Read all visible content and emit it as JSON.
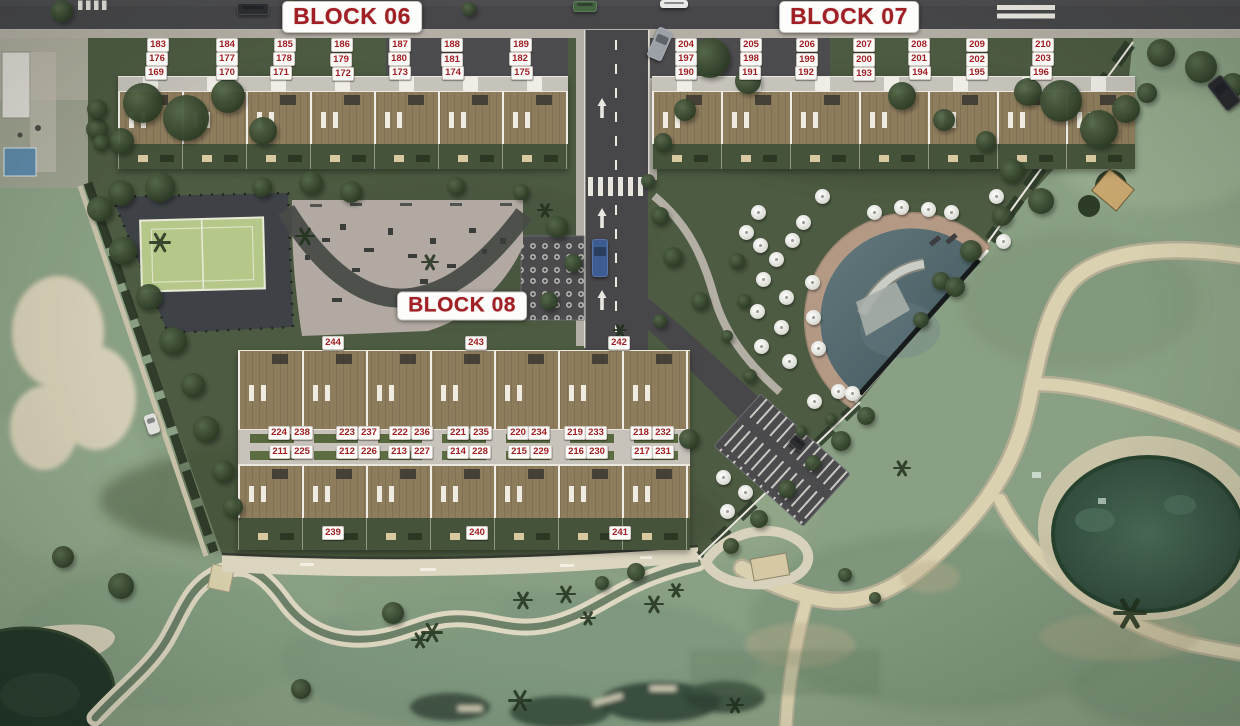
{
  "blocks": [
    {
      "label": "BLOCK 06"
    },
    {
      "label": "BLOCK 07"
    },
    {
      "label": "BLOCK 08"
    }
  ],
  "unit_labels": [
    {
      "t": "183",
      "x": 158,
      "y": 45
    },
    {
      "t": "184",
      "x": 227,
      "y": 45
    },
    {
      "t": "185",
      "x": 285,
      "y": 45
    },
    {
      "t": "186",
      "x": 342,
      "y": 45
    },
    {
      "t": "187",
      "x": 400,
      "y": 45
    },
    {
      "t": "188",
      "x": 452,
      "y": 45
    },
    {
      "t": "189",
      "x": 521,
      "y": 45
    },
    {
      "t": "176",
      "x": 157,
      "y": 59
    },
    {
      "t": "177",
      "x": 227,
      "y": 59
    },
    {
      "t": "178",
      "x": 284,
      "y": 59
    },
    {
      "t": "179",
      "x": 341,
      "y": 60
    },
    {
      "t": "180",
      "x": 399,
      "y": 59
    },
    {
      "t": "181",
      "x": 452,
      "y": 60
    },
    {
      "t": "182",
      "x": 520,
      "y": 59
    },
    {
      "t": "169",
      "x": 156,
      "y": 73
    },
    {
      "t": "170",
      "x": 227,
      "y": 73
    },
    {
      "t": "171",
      "x": 281,
      "y": 73
    },
    {
      "t": "172",
      "x": 343,
      "y": 74
    },
    {
      "t": "173",
      "x": 400,
      "y": 73
    },
    {
      "t": "174",
      "x": 453,
      "y": 73
    },
    {
      "t": "175",
      "x": 522,
      "y": 73
    },
    {
      "t": "204",
      "x": 686,
      "y": 45
    },
    {
      "t": "205",
      "x": 751,
      "y": 45
    },
    {
      "t": "206",
      "x": 807,
      "y": 45
    },
    {
      "t": "207",
      "x": 864,
      "y": 45
    },
    {
      "t": "208",
      "x": 919,
      "y": 45
    },
    {
      "t": "209",
      "x": 977,
      "y": 45
    },
    {
      "t": "210",
      "x": 1043,
      "y": 45
    },
    {
      "t": "197",
      "x": 686,
      "y": 59
    },
    {
      "t": "198",
      "x": 751,
      "y": 59
    },
    {
      "t": "199",
      "x": 807,
      "y": 60
    },
    {
      "t": "200",
      "x": 864,
      "y": 60
    },
    {
      "t": "201",
      "x": 919,
      "y": 59
    },
    {
      "t": "202",
      "x": 977,
      "y": 60
    },
    {
      "t": "203",
      "x": 1043,
      "y": 59
    },
    {
      "t": "190",
      "x": 686,
      "y": 73
    },
    {
      "t": "191",
      "x": 750,
      "y": 73
    },
    {
      "t": "192",
      "x": 806,
      "y": 73
    },
    {
      "t": "193",
      "x": 864,
      "y": 74
    },
    {
      "t": "194",
      "x": 920,
      "y": 73
    },
    {
      "t": "195",
      "x": 977,
      "y": 73
    },
    {
      "t": "196",
      "x": 1041,
      "y": 73
    },
    {
      "t": "244",
      "x": 333,
      "y": 343
    },
    {
      "t": "243",
      "x": 476,
      "y": 343
    },
    {
      "t": "242",
      "x": 619,
      "y": 343
    },
    {
      "t": "224",
      "x": 279,
      "y": 433
    },
    {
      "t": "238",
      "x": 302,
      "y": 433
    },
    {
      "t": "223",
      "x": 347,
      "y": 433
    },
    {
      "t": "237",
      "x": 369,
      "y": 433
    },
    {
      "t": "222",
      "x": 400,
      "y": 433
    },
    {
      "t": "236",
      "x": 422,
      "y": 433
    },
    {
      "t": "221",
      "x": 458,
      "y": 433
    },
    {
      "t": "235",
      "x": 481,
      "y": 433
    },
    {
      "t": "220",
      "x": 518,
      "y": 433
    },
    {
      "t": "234",
      "x": 539,
      "y": 433
    },
    {
      "t": "219",
      "x": 575,
      "y": 433
    },
    {
      "t": "233",
      "x": 596,
      "y": 433
    },
    {
      "t": "218",
      "x": 641,
      "y": 433
    },
    {
      "t": "232",
      "x": 663,
      "y": 433
    },
    {
      "t": "211",
      "x": 280,
      "y": 452
    },
    {
      "t": "225",
      "x": 302,
      "y": 452
    },
    {
      "t": "212",
      "x": 347,
      "y": 452
    },
    {
      "t": "226",
      "x": 369,
      "y": 452
    },
    {
      "t": "213",
      "x": 399,
      "y": 452
    },
    {
      "t": "227",
      "x": 422,
      "y": 452
    },
    {
      "t": "214",
      "x": 458,
      "y": 452
    },
    {
      "t": "228",
      "x": 480,
      "y": 452
    },
    {
      "t": "215",
      "x": 519,
      "y": 452
    },
    {
      "t": "229",
      "x": 541,
      "y": 452
    },
    {
      "t": "216",
      "x": 576,
      "y": 452
    },
    {
      "t": "230",
      "x": 597,
      "y": 452
    },
    {
      "t": "217",
      "x": 642,
      "y": 452
    },
    {
      "t": "231",
      "x": 663,
      "y": 452
    },
    {
      "t": "239",
      "x": 333,
      "y": 533
    },
    {
      "t": "240",
      "x": 477,
      "y": 533
    },
    {
      "t": "241",
      "x": 620,
      "y": 533
    }
  ],
  "colors": {
    "label_red": "#A02025",
    "badge_bg": "#FDFDFB",
    "asphalt": "#47474A",
    "sidewalk": "#B4AFA5",
    "development_green": "#4D5B42",
    "golf_green": "#8AA084",
    "deck_brown": "#8E7D5D",
    "pool_water": "#4E656B",
    "pond_water": "#3C5949",
    "sand_path": "#D9D1B0",
    "court_green": "#B6C78A",
    "umbrella_white": "#F4F4F2"
  },
  "scenery": {
    "trees": [
      [
        143,
        103,
        40
      ],
      [
        186,
        118,
        46
      ],
      [
        228,
        96,
        34
      ],
      [
        263,
        131,
        28
      ],
      [
        121,
        141,
        26
      ],
      [
        97,
        129,
        22
      ],
      [
        160,
        187,
        30
      ],
      [
        121,
        193,
        26
      ],
      [
        262,
        187,
        20
      ],
      [
        311,
        183,
        24
      ],
      [
        351,
        192,
        22
      ],
      [
        456,
        186,
        18
      ],
      [
        521,
        192,
        16
      ],
      [
        557,
        227,
        22
      ],
      [
        573,
        263,
        18
      ],
      [
        549,
        301,
        18
      ],
      [
        710,
        58,
        40
      ],
      [
        748,
        81,
        26
      ],
      [
        685,
        110,
        22
      ],
      [
        663,
        142,
        18
      ],
      [
        902,
        96,
        28
      ],
      [
        944,
        120,
        22
      ],
      [
        1028,
        92,
        28
      ],
      [
        1061,
        101,
        42
      ],
      [
        1099,
        129,
        38
      ],
      [
        1126,
        109,
        28
      ],
      [
        986,
        141,
        20
      ],
      [
        1012,
        171,
        24
      ],
      [
        1041,
        201,
        26
      ],
      [
        1002,
        216,
        20
      ],
      [
        971,
        251,
        22
      ],
      [
        941,
        281,
        18
      ],
      [
        955,
        287,
        20
      ],
      [
        921,
        320,
        16
      ],
      [
        866,
        416,
        18
      ],
      [
        841,
        441,
        20
      ],
      [
        813,
        463,
        16
      ],
      [
        787,
        489,
        18
      ],
      [
        759,
        519,
        18
      ],
      [
        731,
        546,
        16
      ],
      [
        737,
        261,
        16
      ],
      [
        744,
        301,
        14
      ],
      [
        727,
        336,
        12
      ],
      [
        750,
        376,
        14
      ],
      [
        801,
        431,
        12
      ],
      [
        831,
        419,
        12
      ],
      [
        1161,
        53,
        28
      ],
      [
        1201,
        67,
        32
      ],
      [
        1233,
        85,
        24
      ],
      [
        1147,
        93,
        20
      ],
      [
        100,
        209,
        26
      ],
      [
        123,
        251,
        28
      ],
      [
        149,
        297,
        26
      ],
      [
        173,
        341,
        28
      ],
      [
        193,
        385,
        24
      ],
      [
        206,
        429,
        26
      ],
      [
        223,
        471,
        22
      ],
      [
        233,
        507,
        20
      ],
      [
        689,
        439,
        20
      ],
      [
        393,
        613,
        22
      ],
      [
        301,
        689,
        20
      ],
      [
        121,
        586,
        26
      ],
      [
        63,
        557,
        22
      ],
      [
        97,
        109,
        20
      ],
      [
        101,
        143,
        16
      ],
      [
        62,
        11,
        22
      ],
      [
        293,
        7,
        16
      ],
      [
        469,
        9,
        14
      ],
      [
        648,
        181,
        14
      ],
      [
        660,
        216,
        18
      ],
      [
        673,
        257,
        20
      ],
      [
        700,
        301,
        18
      ],
      [
        660,
        321,
        14
      ],
      [
        636,
        572,
        18
      ],
      [
        602,
        583,
        14
      ],
      [
        845,
        575,
        14
      ],
      [
        875,
        598,
        12
      ]
    ],
    "palms": [
      [
        432,
        632,
        22
      ],
      [
        523,
        600,
        20
      ],
      [
        566,
        594,
        20
      ],
      [
        654,
        604,
        20
      ],
      [
        676,
        590,
        16
      ],
      [
        520,
        700,
        24
      ],
      [
        420,
        640,
        18
      ],
      [
        1130,
        612,
        34
      ],
      [
        902,
        468,
        18
      ],
      [
        735,
        705,
        18
      ],
      [
        588,
        618,
        16
      ],
      [
        160,
        242,
        22
      ],
      [
        305,
        236,
        20
      ],
      [
        430,
        262,
        18
      ],
      [
        545,
        210,
        16
      ],
      [
        620,
        330,
        14
      ]
    ],
    "umbrellas": [
      [
        758,
        212
      ],
      [
        803,
        222
      ],
      [
        822,
        196
      ],
      [
        746,
        232
      ],
      [
        760,
        245
      ],
      [
        776,
        259
      ],
      [
        792,
        240
      ],
      [
        763,
        279
      ],
      [
        786,
        297
      ],
      [
        812,
        282
      ],
      [
        757,
        311
      ],
      [
        781,
        327
      ],
      [
        813,
        317
      ],
      [
        761,
        346
      ],
      [
        789,
        361
      ],
      [
        818,
        348
      ],
      [
        838,
        391
      ],
      [
        814,
        401
      ],
      [
        852,
        393
      ],
      [
        874,
        212
      ],
      [
        901,
        207
      ],
      [
        928,
        209
      ],
      [
        951,
        212
      ],
      [
        996,
        196
      ],
      [
        1003,
        241
      ],
      [
        723,
        477
      ],
      [
        745,
        492
      ],
      [
        727,
        511
      ]
    ]
  },
  "cars": [
    [
      237,
      3,
      32,
      12,
      "#2b2d31",
      0
    ],
    [
      573,
      1,
      24,
      11,
      "#44653f",
      0
    ],
    [
      652,
      28,
      16,
      32,
      "#9ba1a7",
      24
    ],
    [
      660,
      0,
      28,
      8,
      "#e8e8e6",
      0
    ],
    [
      1215,
      76,
      18,
      34,
      "#26282c",
      -38
    ],
    [
      592,
      239,
      16,
      38,
      "#3d5c92",
      0
    ],
    [
      146,
      414,
      12,
      20,
      "#dfe0dc",
      -18
    ],
    [
      790,
      437,
      16,
      12,
      "#2c2e30",
      40
    ]
  ]
}
